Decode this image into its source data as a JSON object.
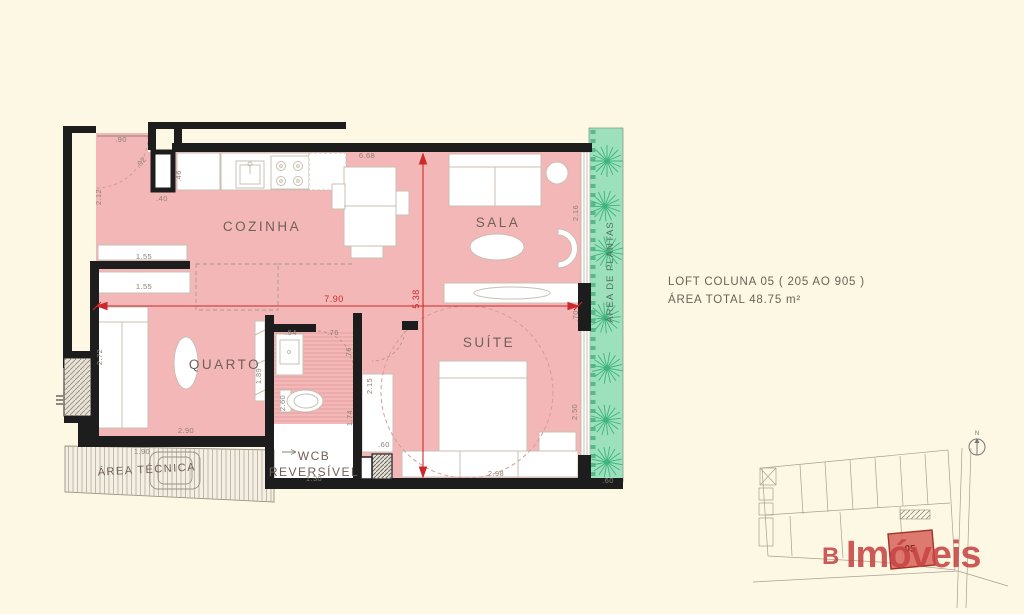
{
  "info": {
    "title": "LOFT COLUNA 05 ( 205 AO 905 )",
    "area_total": "ÁREA TOTAL  48.75 m²"
  },
  "rooms": {
    "cozinha": "COZINHA",
    "sala": "SALA",
    "quarto": "QUARTO",
    "suite": "SUÍTE",
    "wcb_line1": "WCB",
    "wcb_line2": "REVERSÍVEL",
    "area_tecnica": "ÁREA TÉCNICA",
    "area_plantas": "ÁREA DE PLANTAS"
  },
  "dims_red": {
    "total_width": "7.90",
    "total_height": "5.38"
  },
  "dims": {
    "entry_door": ".90",
    "door_swing": ".92",
    "entry_depth": "2.12",
    "column_side": ".46",
    "column_width": ".40",
    "kitchen_sala_width": "6.68",
    "sala_window": "2.16",
    "shelf_top": "1.55",
    "shelf_bottom": "1.55",
    "quarto_depth": "2.72",
    "quarto_panel": "1.89",
    "quarto_width": "2.90",
    "area_tecnica_width": "1.90",
    "basin_width": ".54",
    "wcb_door_top": ".76",
    "wcb_door_side": ".76",
    "wcb_depth": "2.60",
    "wcb_side": "1.74",
    "wcb_width": "1.30",
    "suite_closet": "2.15",
    "suite_shaft": ".60",
    "suite_width": "2.98",
    "suite_window": "2.50",
    "sala_suite_wall": ".70",
    "plantas_width": ".60"
  },
  "keyplan": {
    "unit": "05",
    "north_label": "N"
  },
  "logo": {
    "prefix": "B",
    "name": "Imóveis"
  },
  "colors": {
    "background": "#fdf8e3",
    "floor_pink": "#f4b7b7",
    "plantas_green": "#9ce0bc",
    "plant_stroke": "#3fb47c",
    "wall_black": "#1d1d1d",
    "dimension_red": "#cc2a2a",
    "dimension_gray": "#8d8175",
    "logo_red": "#c64343",
    "keyplan_gray": "#a89f91"
  }
}
